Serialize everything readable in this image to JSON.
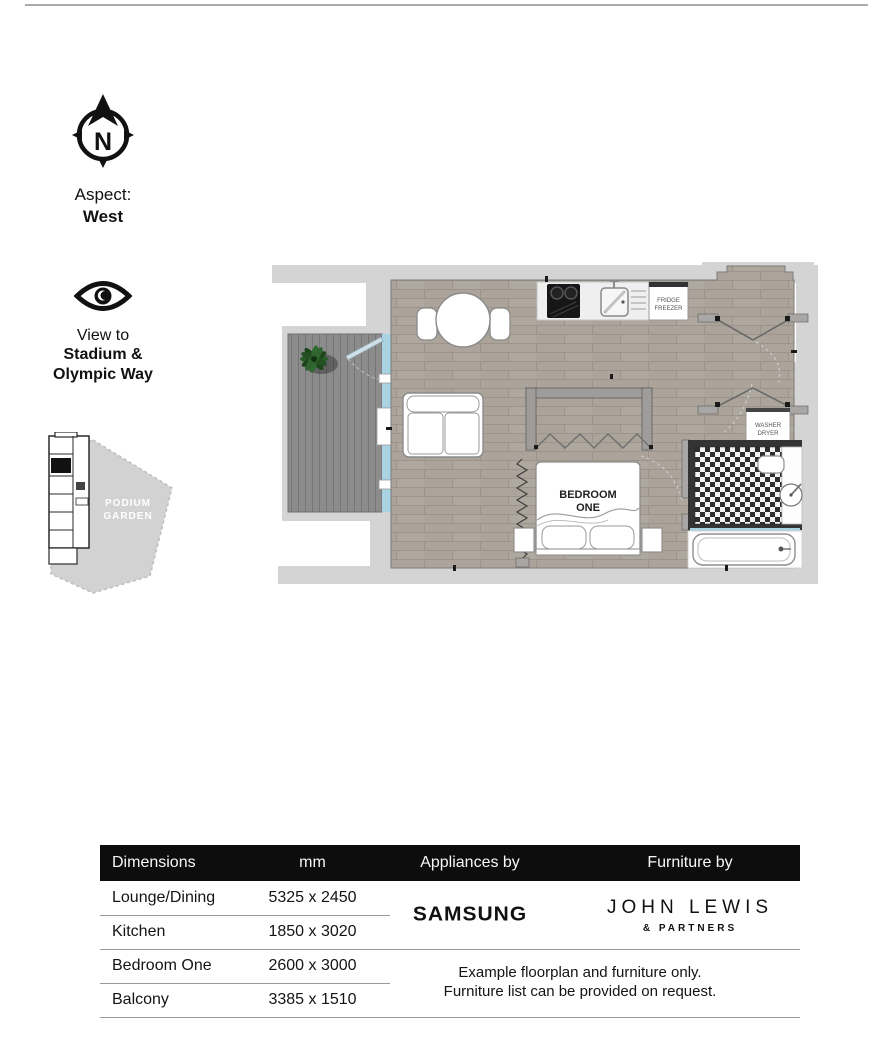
{
  "compass": {
    "letter": "N",
    "aspect_label": "Aspect:",
    "aspect_value": "West"
  },
  "view": {
    "label": "View to",
    "line1": "Stadium &",
    "line2": "Olympic Way"
  },
  "site_plan": {
    "garden_line1": "PODIUM",
    "garden_line2": "GARDEN"
  },
  "floorplan": {
    "bedroom_line1": "BEDROOM",
    "bedroom_line2": "ONE",
    "fridge_line1": "FRIDGE",
    "fridge_line2": "FREEZER",
    "washer_line1": "WASHER",
    "washer_line2": "DRYER",
    "colors": {
      "slab": "#d4d4d4",
      "deck": "#8c8c8c",
      "wood": "#aca49b",
      "glass": "#a9d3e2",
      "wall": "#a9a7a5",
      "dark_wall": "#343434",
      "table_header_bg": "#0d0d0d"
    }
  },
  "table": {
    "headers": [
      "Dimensions",
      "mm",
      "Appliances by",
      "Furniture by"
    ],
    "rows": [
      {
        "name": "Lounge/Dining",
        "mm": "5325 x 2450"
      },
      {
        "name": "Kitchen",
        "mm": "1850 x 3020"
      },
      {
        "name": "Bedroom One",
        "mm": "2600 x 3000"
      },
      {
        "name": "Balcony",
        "mm": "3385 x 1510"
      }
    ],
    "appliances_brand": "SAMSUNG",
    "furniture_brand_line1": "JOHN LEWIS",
    "furniture_brand_line2": "& PARTNERS",
    "note_line1": "Example floorplan and furniture only.",
    "note_line2": "Furniture list can be provided on request."
  }
}
